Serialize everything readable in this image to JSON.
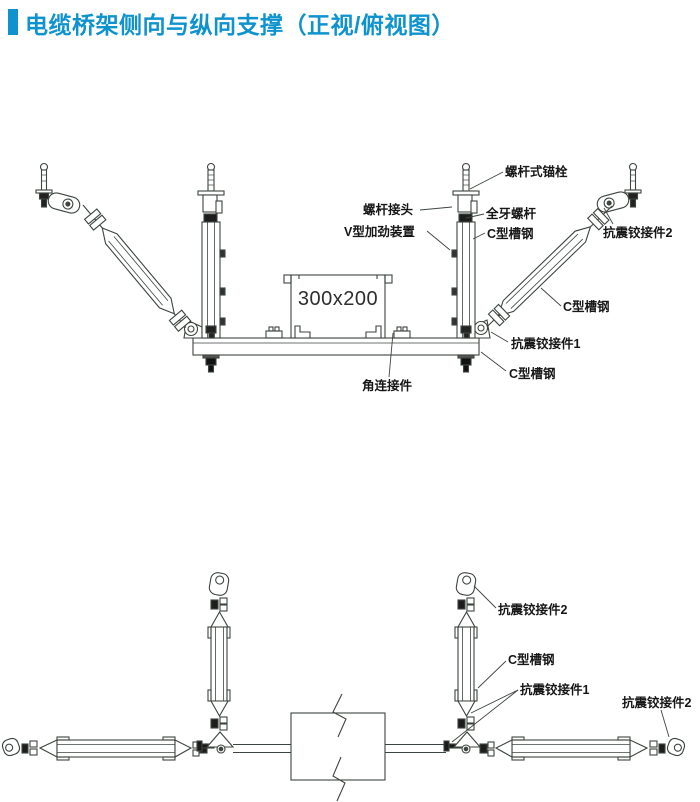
{
  "title": {
    "text": "电缆桥架侧向与纵向支撑（正视/俯视图）",
    "accent_color": "#0f93ce"
  },
  "front_view": {
    "name": "正视图",
    "tray_size": "300x200",
    "labels": {
      "anchor_bolt": "螺杆式锚栓",
      "rod_coupler": "螺杆接头",
      "threaded_rod": "全牙螺杆",
      "v_stiffener": "V型加劲装置",
      "c_channel_vertical": "C型槽钢",
      "hinge_2": "抗震铰接件2",
      "c_channel_diagonal": "C型槽钢",
      "hinge_1": "抗震铰接件1",
      "c_channel_bottom": "C型槽钢",
      "angle_connector": "角连接件"
    }
  },
  "top_view": {
    "name": "俯视图",
    "labels": {
      "hinge_2_top": "抗震铰接件2",
      "c_channel": "C型槽钢",
      "hinge_1": "抗震铰接件1",
      "hinge_2_right": "抗震铰接件2"
    }
  }
}
